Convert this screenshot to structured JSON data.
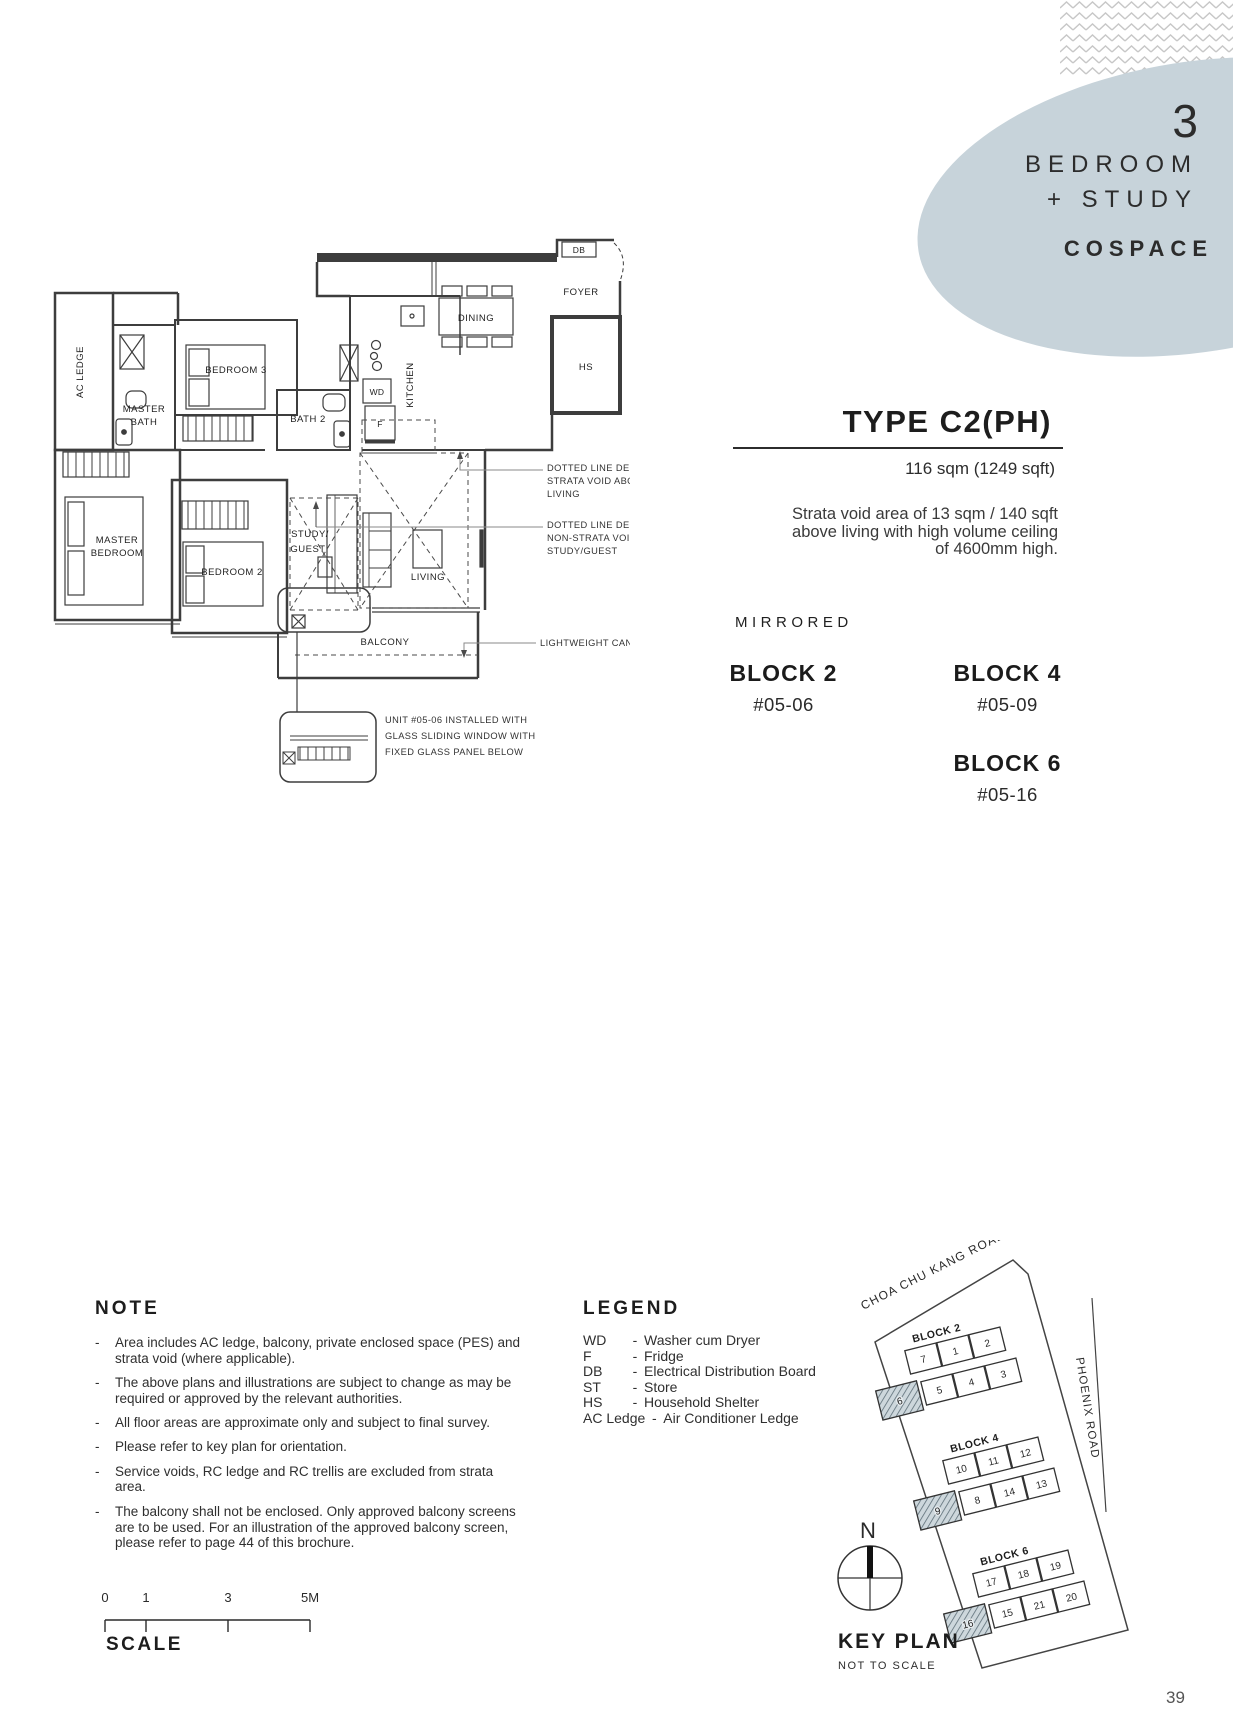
{
  "ui": {
    "dash": "-"
  },
  "hero": {
    "number": "3",
    "title_line1": "BEDROOM",
    "title_line2": "+ STUDY",
    "brand": "COSPACE"
  },
  "type_info": {
    "title": "TYPE C2(PH)",
    "area": "116 sqm (1249 sqft)",
    "void_note_lines": [
      "Strata void area of 13 sqm / 140 sqft",
      "above living with high volume ceiling",
      "of 4600mm high."
    ],
    "mirrored": "MIRRORED",
    "blocks": [
      {
        "name": "BLOCK 2",
        "unit": "#05-06"
      },
      {
        "name": "BLOCK 4",
        "unit": "#05-09"
      },
      {
        "name": "BLOCK 6",
        "unit": "#05-16"
      }
    ]
  },
  "floorplan": {
    "rooms": {
      "ac_ledge": "AC LEDGE",
      "master_bath_l1": "MASTER",
      "master_bath_l2": "BATH",
      "bedroom3": "BEDROOM 3",
      "bath2": "BATH 2",
      "wd": "WD",
      "f": "F",
      "db": "DB",
      "hs": "HS",
      "kitchen": "KITCHEN",
      "dining": "DINING",
      "foyer": "FOYER",
      "master_bed_l1": "MASTER",
      "master_bed_l2": "BEDROOM",
      "bedroom2": "BEDROOM 2",
      "study_l1": "STUDY/",
      "study_l2": "GUEST",
      "living": "LIVING",
      "balcony": "BALCONY"
    },
    "annotations": {
      "strata_void": [
        "DOTTED LINE DENOTES",
        "STRATA VOID ABOVE",
        "LIVING"
      ],
      "non_strata_void": [
        "DOTTED LINE DENOTES",
        "NON-STRATA VOID ABOVE",
        "STUDY/GUEST"
      ],
      "canopy": "LIGHTWEIGHT CANOPY ABOVE",
      "window_detail": [
        "UNIT #05-06 INSTALLED WITH",
        "GLASS SLIDING WINDOW WITH",
        "FIXED GLASS PANEL BELOW"
      ]
    }
  },
  "note": {
    "title": "NOTE",
    "items": [
      "Area includes AC ledge, balcony, private enclosed space (PES) and strata void (where applicable).",
      "The above plans and illustrations are subject to change as may be required or approved by the relevant authorities.",
      "All floor areas are approximate only and subject to final survey.",
      "Please refer to key plan for orientation.",
      "Service voids, RC ledge and RC trellis are excluded from strata area.",
      "The balcony shall not be enclosed. Only approved balcony screens are to be used. For an illustration of the approved balcony screen, please refer to page 44 of this brochure."
    ]
  },
  "legend": {
    "title": "LEGEND",
    "entries": [
      {
        "abbr": "WD",
        "desc": "Washer cum Dryer"
      },
      {
        "abbr": "F",
        "desc": "Fridge"
      },
      {
        "abbr": "DB",
        "desc": "Electrical Distribution Board"
      },
      {
        "abbr": "ST",
        "desc": "Store"
      },
      {
        "abbr": "HS",
        "desc": "Household Shelter"
      },
      {
        "abbr": "AC Ledge",
        "desc": "Air Conditioner Ledge"
      }
    ]
  },
  "keyplan": {
    "title": "KEY PLAN",
    "subtitle": "NOT TO SCALE",
    "compass": "N",
    "road_top": "CHOA CHU KANG ROAD",
    "road_right": "PHOENIX ROAD",
    "blocks": [
      {
        "name": "BLOCK 2",
        "highlight": "6",
        "row1": [
          "7",
          "1",
          "2"
        ],
        "row2": [
          "5",
          "4",
          "3"
        ]
      },
      {
        "name": "BLOCK 4",
        "highlight": "9",
        "row1": [
          "10",
          "11",
          "12"
        ],
        "row2": [
          "8",
          "14",
          "13"
        ]
      },
      {
        "name": "BLOCK 6",
        "highlight": "16",
        "row1": [
          "17",
          "18",
          "19"
        ],
        "row2": [
          "15",
          "21",
          "20"
        ]
      }
    ]
  },
  "scale": {
    "title": "SCALE",
    "ticks": [
      "0",
      "1",
      "3",
      "5M"
    ]
  },
  "page_number": "39"
}
